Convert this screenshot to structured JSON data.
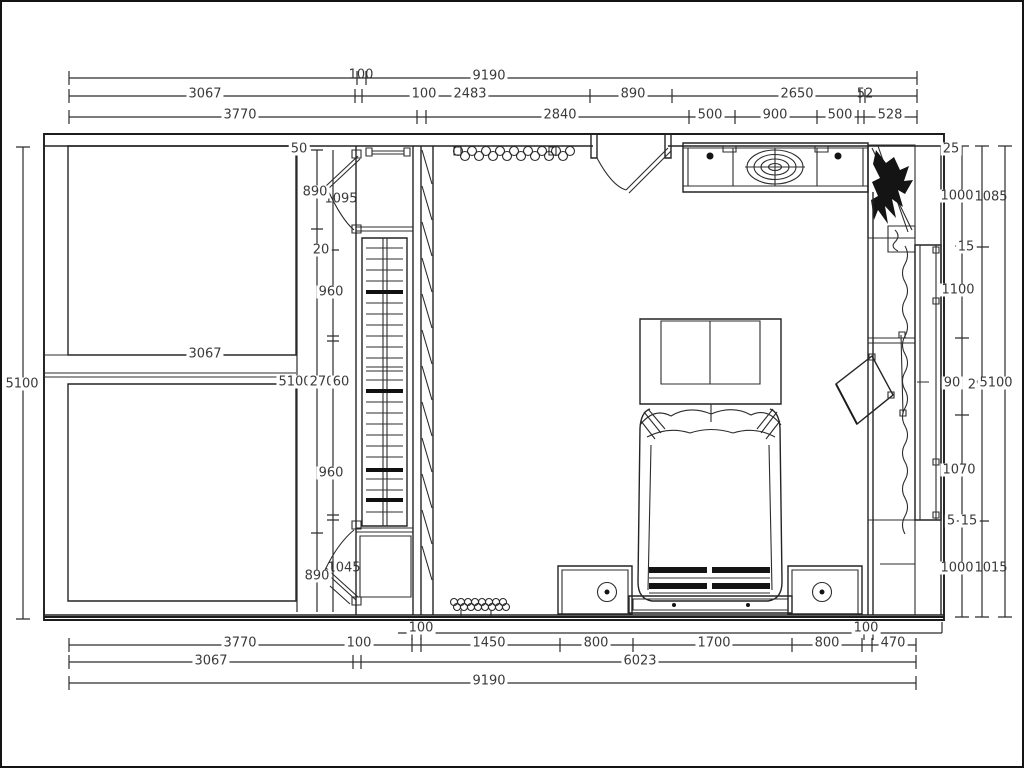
{
  "drawing": {
    "kind": "bedroom floor plan (CAD line drawing)",
    "unit": "mm",
    "line_color": "#1c1c1c",
    "text_color": "#3a3a3a",
    "background": "#ffffff"
  },
  "dims": {
    "top": {
      "row1": [
        "100",
        "9190"
      ],
      "row2": [
        "3067",
        "100",
        "2483",
        "890",
        "2650",
        "52"
      ],
      "row3": [
        "3770",
        "2840",
        "500",
        "900",
        "500",
        "528"
      ]
    },
    "bottom": {
      "row0": [
        "100",
        "100"
      ],
      "row1": [
        "3770",
        "100",
        "1450",
        "800",
        "1700",
        "800",
        "470"
      ],
      "row2": [
        "3067",
        "6023"
      ],
      "row3": [
        "9190"
      ]
    },
    "left": {
      "overall": "5100"
    },
    "right": {
      "col1": [
        "25",
        "1000",
        "15",
        "1100",
        "90",
        "1070",
        "5",
        "15",
        "1000"
      ],
      "col2": [
        "1085",
        "29",
        "1015"
      ],
      "col3": [
        "5100"
      ]
    },
    "interior": {
      "closet_col": [
        "50",
        "890",
        "1095",
        "20",
        "960",
        "3067",
        "5100",
        "270",
        "60",
        "960",
        "890",
        "1045"
      ]
    }
  }
}
